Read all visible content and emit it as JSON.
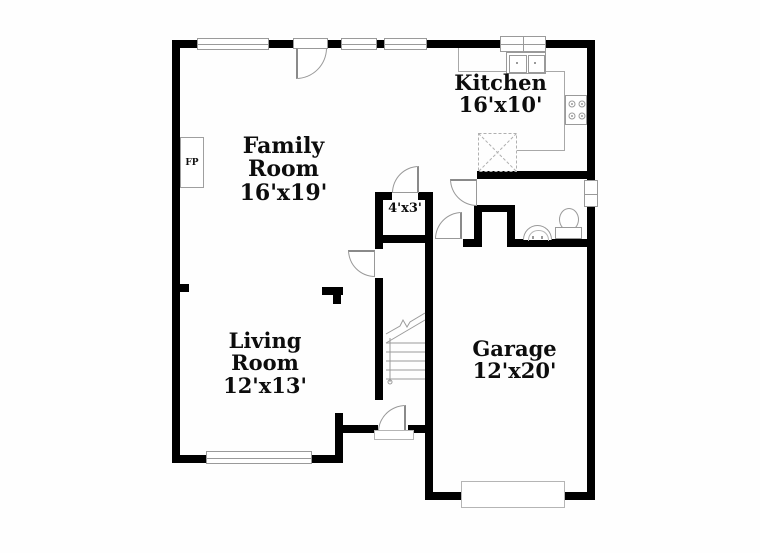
{
  "floorplan": {
    "rooms": {
      "kitchen": {
        "name": "Kitchen",
        "dims": "16'x10'"
      },
      "family": {
        "name": "Family Room",
        "dims": "16'x19'"
      },
      "living": {
        "name": "Living Room",
        "dims": "12'x13'"
      },
      "garage": {
        "name": "Garage",
        "dims": "12'x20'"
      },
      "closet": {
        "dims": "4'x3'"
      }
    },
    "fireplace_label": "FP",
    "colors": {
      "wall": "#000000",
      "fixture_line": "#9a9a9a",
      "background": "#ffffff",
      "text": "#0d0d0d"
    },
    "fixtures": [
      "fireplace",
      "kitchen-sink",
      "stove",
      "pantry-x-box",
      "bathroom-sink",
      "toilet",
      "stairs",
      "front-door-threshold",
      "garage-door",
      "windows",
      "doors"
    ]
  }
}
